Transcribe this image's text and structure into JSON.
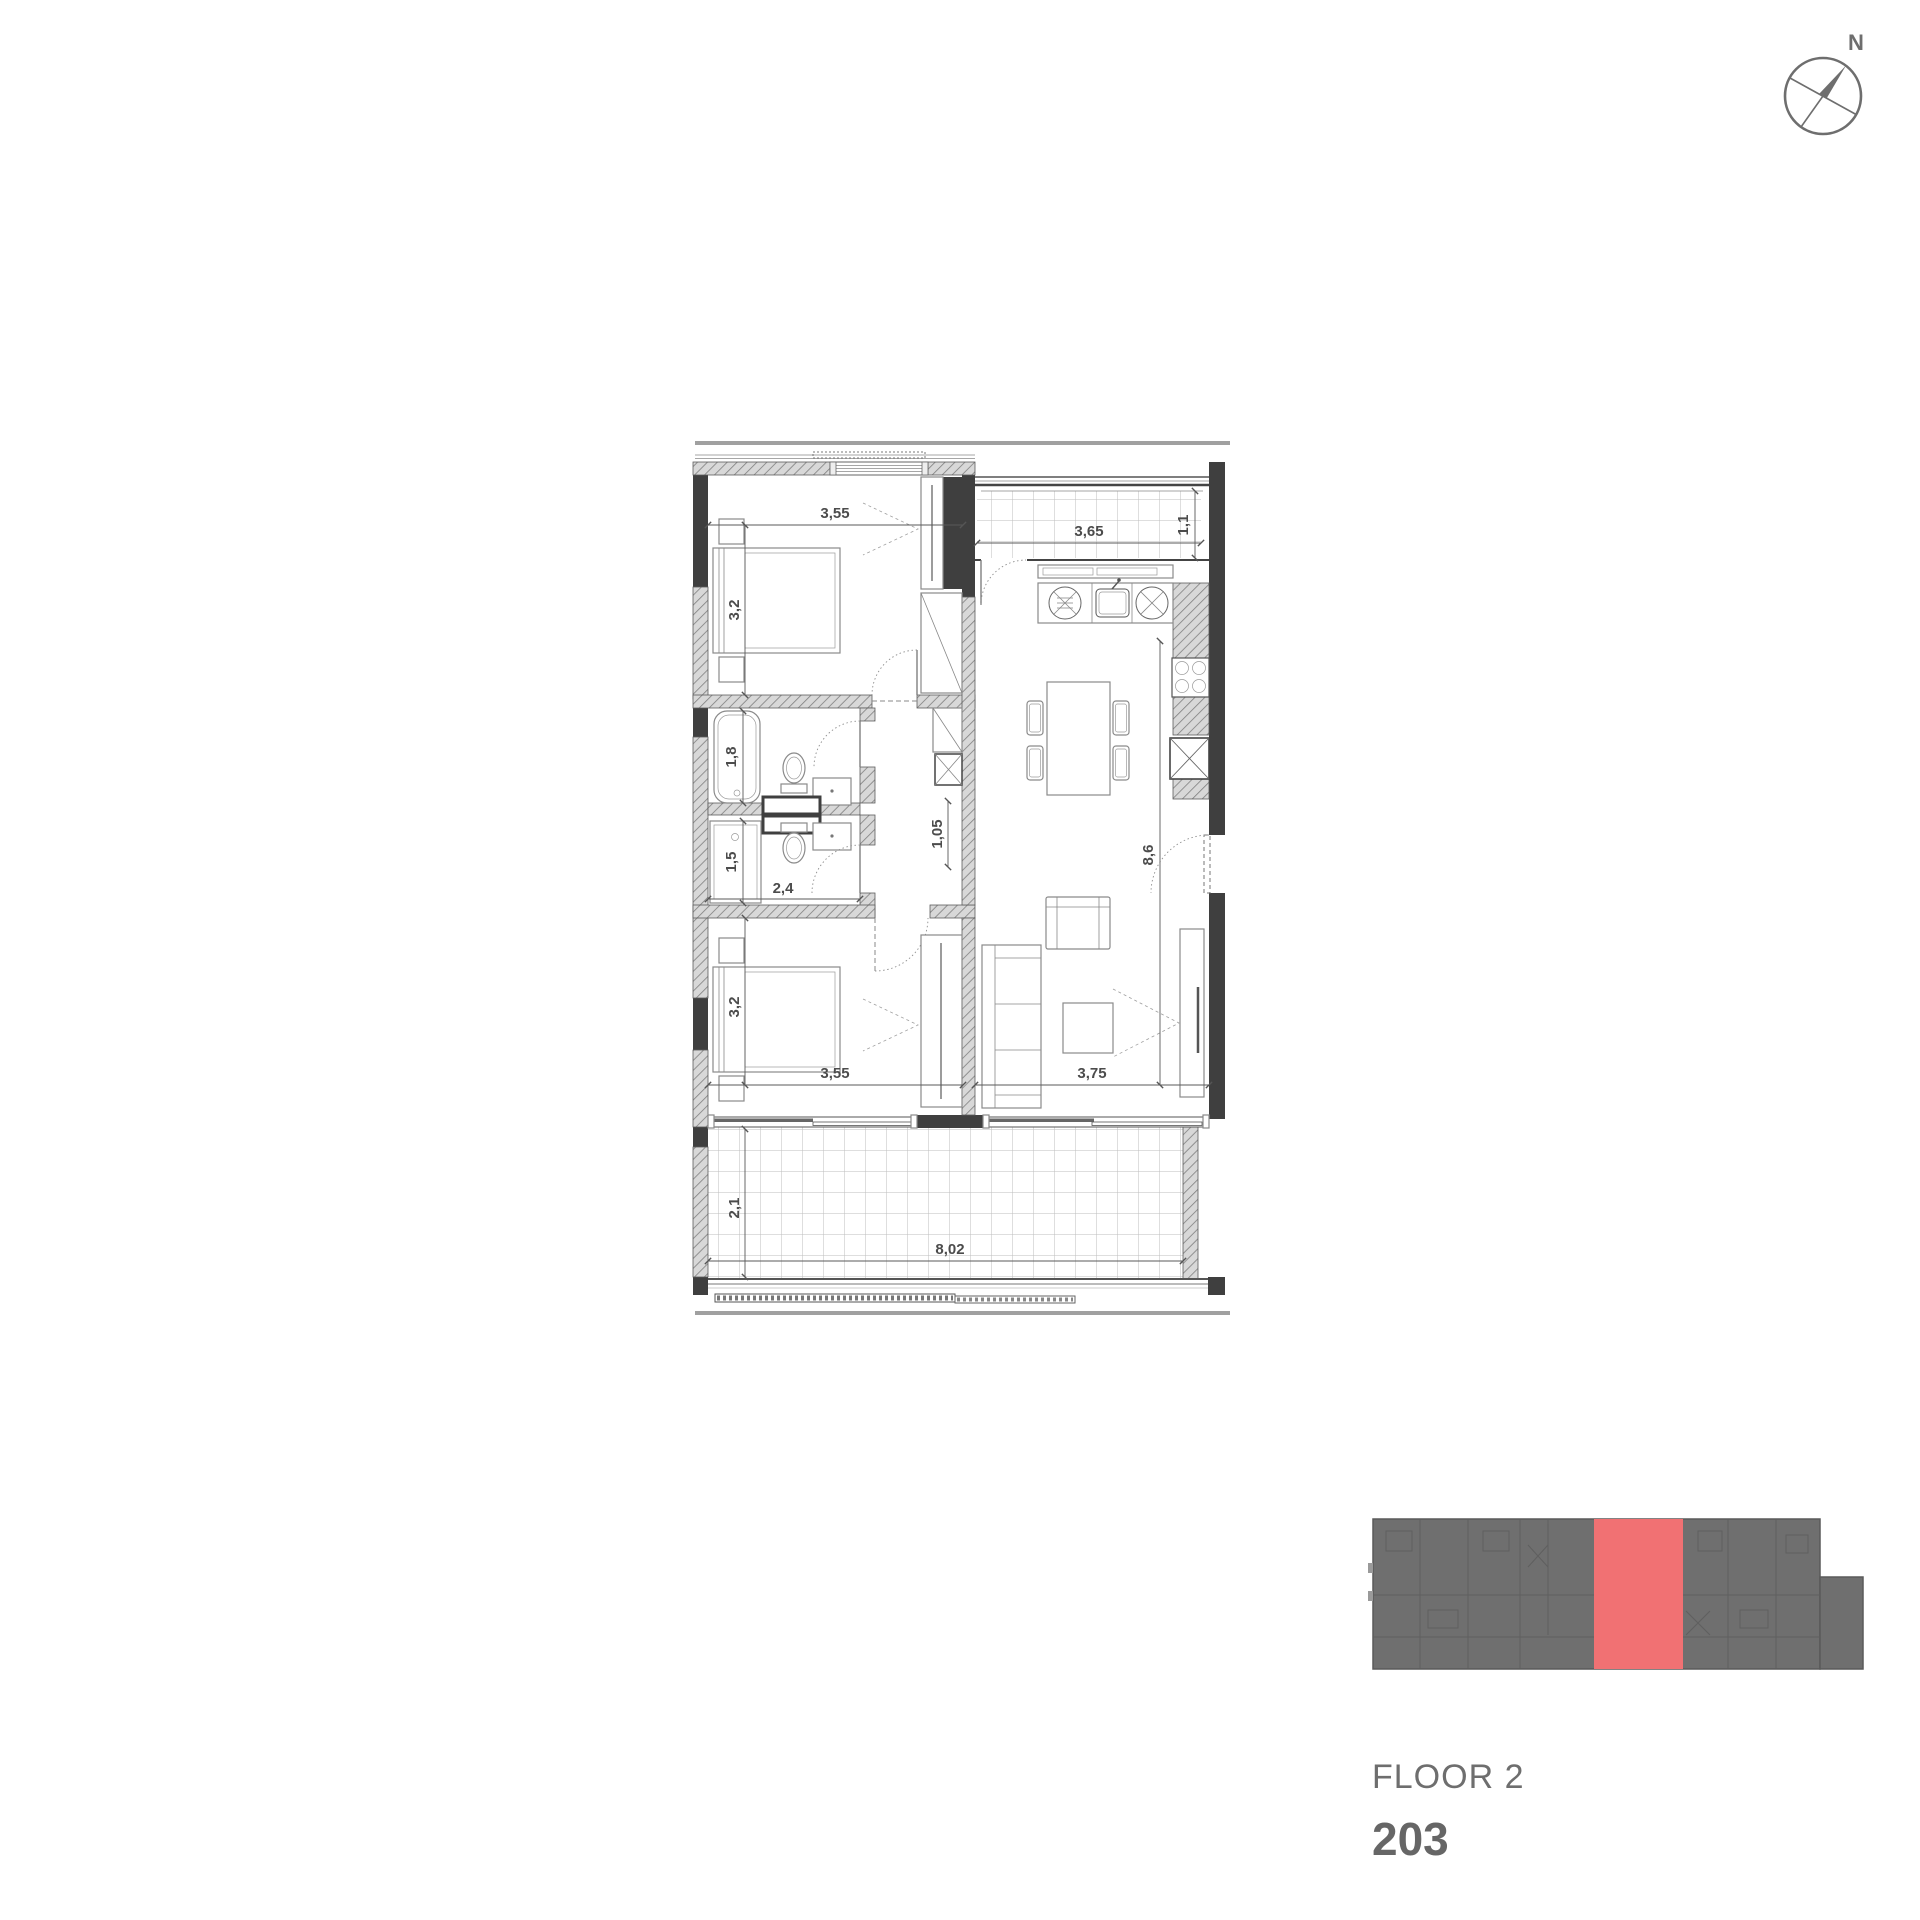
{
  "compass": {
    "north_label": "N"
  },
  "plan": {
    "dims": {
      "bedroom1_width": "3,55",
      "bedroom1_depth": "3,2",
      "balcony_width": "3,65",
      "balcony_depth": "1,1",
      "bath1_length": "1,8",
      "shower_length": "1,5",
      "bath2_width": "2,4",
      "hall_width": "1,05",
      "living_length": "8,6",
      "bedroom2_depth": "3,2",
      "bedroom2_width": "3,55",
      "living_width": "3,75",
      "terrace_depth": "2,1",
      "terrace_width": "8,02"
    }
  },
  "legend": {
    "floor_label": "FLOOR 2",
    "unit_label": "203"
  },
  "colors": {
    "highlight": "#f17173",
    "minimap_gray": "#6f6f6f",
    "wall_dark": "#3f3f3f",
    "text_gray": "#6e6e6e"
  }
}
